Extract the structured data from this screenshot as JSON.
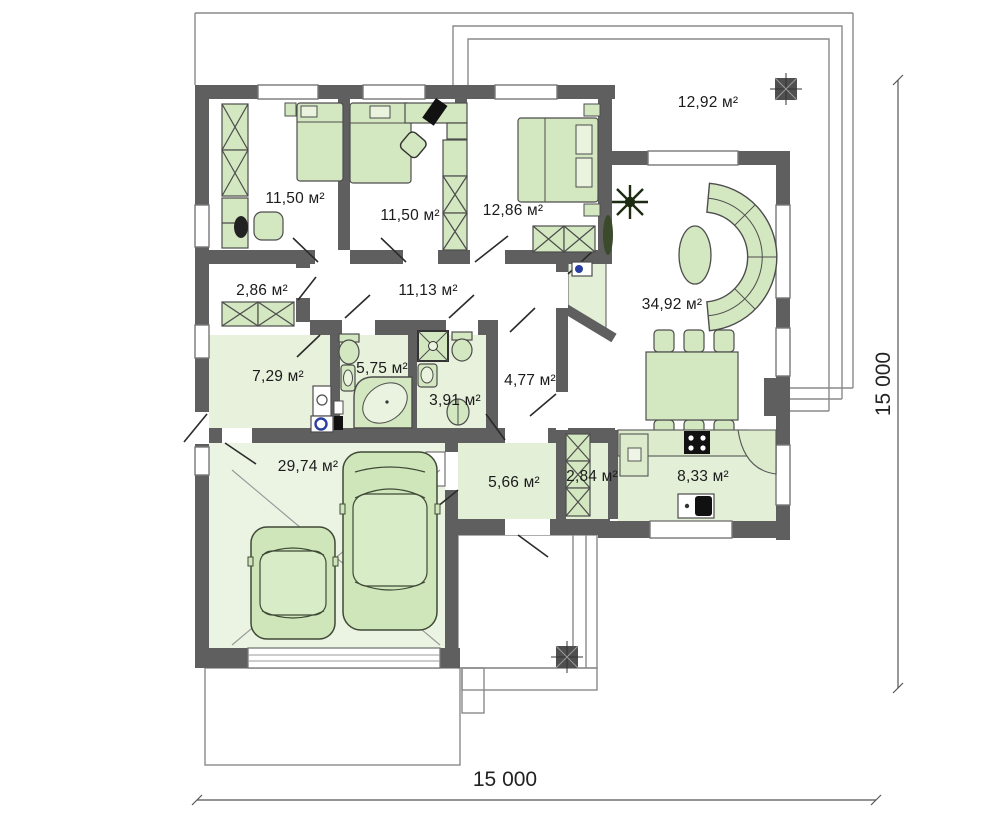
{
  "plan_type": "single-storey house floor plan",
  "rooms": {
    "bedroom_1": {
      "label": "11,50 м²"
    },
    "bedroom_2": {
      "label": "11,50 м²"
    },
    "bedroom_3": {
      "label": "12,86 м²"
    },
    "terrace": {
      "label": "12,92 м²"
    },
    "wardrobe": {
      "label": "2,86 м²"
    },
    "corridor": {
      "label": "11,13 м²"
    },
    "living_room": {
      "label": "34,92 м²"
    },
    "utility": {
      "label": "7,29 м²"
    },
    "bathroom": {
      "label": "5,75 м²"
    },
    "shower_room": {
      "label": "3,91 м²"
    },
    "hall": {
      "label": "4,77 м²"
    },
    "garage": {
      "label": "29,74 м²"
    },
    "entry": {
      "label": "5,66 м²"
    },
    "pantry": {
      "label": "2,84 м²"
    },
    "kitchen": {
      "label": "8,33 м²"
    }
  },
  "dimensions": {
    "overall_width": "15 000",
    "overall_height": "15 000"
  },
  "colors": {
    "wall": "#5f5f5f",
    "furniture_fill": "#d3e7c0",
    "floor_tint": "#e7f1dc",
    "floor_tint_light": "#ebf4e3",
    "site_line": "#8a8a8a",
    "accent_blue": "#2a3f9f"
  }
}
